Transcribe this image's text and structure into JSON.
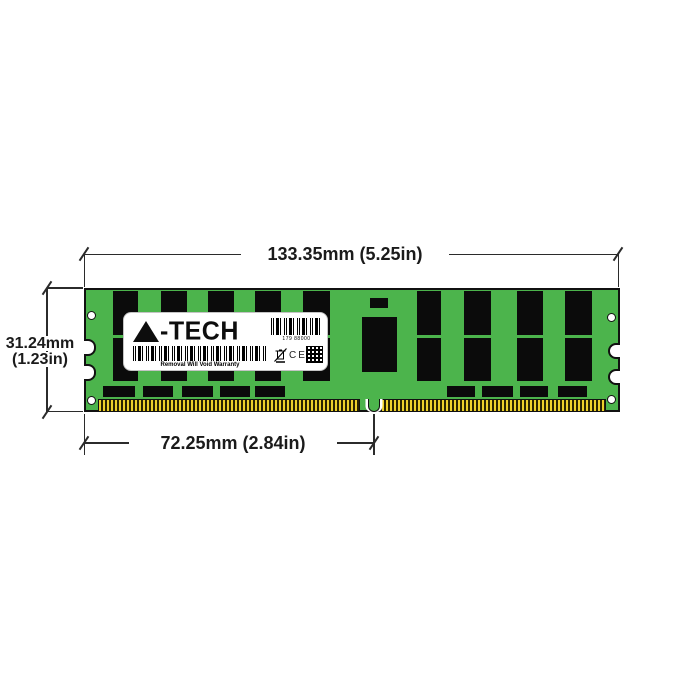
{
  "page": {
    "background": "#ffffff",
    "description": "A-Tech server RAM memory module dimension diagram"
  },
  "module": {
    "name": "A-Tech DDR4 LRDIMM memory module",
    "pcb_color": "#4CB44C",
    "chip_color": "#0B0B0B",
    "pin_gold_color": "#EDD02C",
    "dram_columns_left": 5,
    "dram_columns_right": 4,
    "chip_rows": 2,
    "mounting_holes": 4,
    "edge_notches_per_side": 2
  },
  "label": {
    "brand": "A-TECH",
    "logo_suffix": "-TECH",
    "serial": "179 88000",
    "warranty": "Removal Will Void Warranty",
    "ce_mark": "CE"
  },
  "dimensions": {
    "top_width": "133.35mm (5.25in)",
    "height_mm": "31.24mm",
    "height_in": "(1.23in)",
    "pin_span": "72.25mm (2.84in)"
  }
}
